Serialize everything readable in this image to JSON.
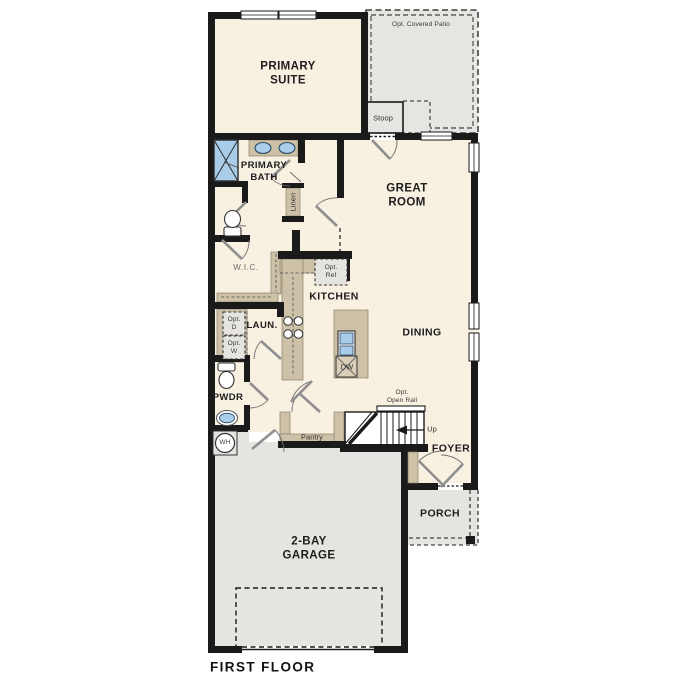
{
  "floor_title": "FIRST FLOOR",
  "labels": {
    "opt_covered_patio": "Opt. Covered Patio",
    "stoop": "Stoop",
    "primary_suite": "PRIMARY\nSUITE",
    "great_room": "GREAT\nROOM",
    "primary_bath": "PRIMARY\nBATH",
    "linen": "Linen",
    "wic": "W.I.C.",
    "opt_ref": "Opt.\nRef",
    "kitchen": "KITCHEN",
    "dining": "DINING",
    "laundry": "LAUN.",
    "opt_d": "Opt.\nD",
    "opt_w": "Opt.\nW",
    "dw": "DW",
    "pwdr": "PWDR",
    "wh": "WH",
    "pantry": "Pantry",
    "opt_open_rail": "Opt.\nOpen Rail",
    "up": "Up",
    "foyer": "FOYER",
    "porch": "PORCH",
    "garage": "2-BAY\nGARAGE"
  },
  "colors": {
    "floor": "#f8f0e1",
    "outdoor": "#e7e5e1",
    "cabinet": "#cdc2a8",
    "fixture_blue": "#a9cce9",
    "wall": "#1a1a1a",
    "text": "#1d1d1d"
  }
}
